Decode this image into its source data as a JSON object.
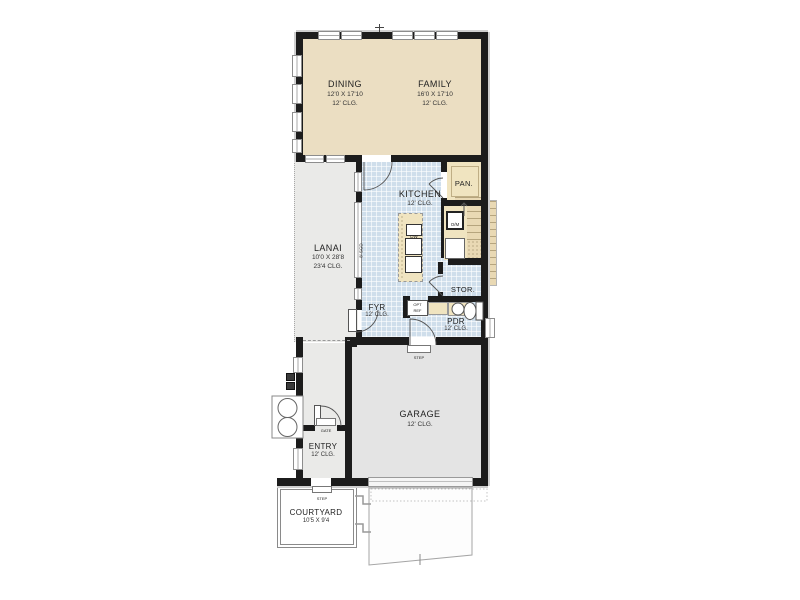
{
  "rooms": {
    "dining": {
      "name": "DINING",
      "dims": "12'0 X 17'10",
      "clg": "12' CLG."
    },
    "family": {
      "name": "FAMILY",
      "dims": "16'0 X 17'10",
      "clg": "12' CLG."
    },
    "kitchen": {
      "name": "KITCHEN",
      "clg": "12' CLG."
    },
    "lanai": {
      "name": "LANAI",
      "dims": "10'0 X 28'8",
      "clg": "23'4 CLG."
    },
    "pantry": {
      "name": "PAN."
    },
    "stor": {
      "name": "STOR."
    },
    "foyer": {
      "name": "FYR",
      "clg": "12' CLG."
    },
    "powder": {
      "name": "PDR",
      "clg": "12' CLG."
    },
    "garage": {
      "name": "GARAGE",
      "clg": "12' CLG."
    },
    "entry": {
      "name": "ENTRY",
      "clg": "12' CLG."
    },
    "courtyard": {
      "name": "COURTYARD",
      "dims": "10'5 X 9'4"
    }
  },
  "fixtures": {
    "dishwasher": "DW",
    "oven_micro": "O/M",
    "opt_ref_line1": "OPT",
    "opt_ref_line2": "REF",
    "gate": "GATE",
    "step_foyer": "STEP",
    "step_courtyard": "STEP",
    "sliding_door": "8' SGD"
  },
  "colors": {
    "wall": "#1c1c1c",
    "dining_family_floor": "#ebdec2",
    "kitchen_tile": "#cfdeeb",
    "lanai_floor": "#eaeae8",
    "garage_floor": "#e4e4e4",
    "counter_tan": "#f0e4c0",
    "outline_gray": "#cfcfcf"
  }
}
